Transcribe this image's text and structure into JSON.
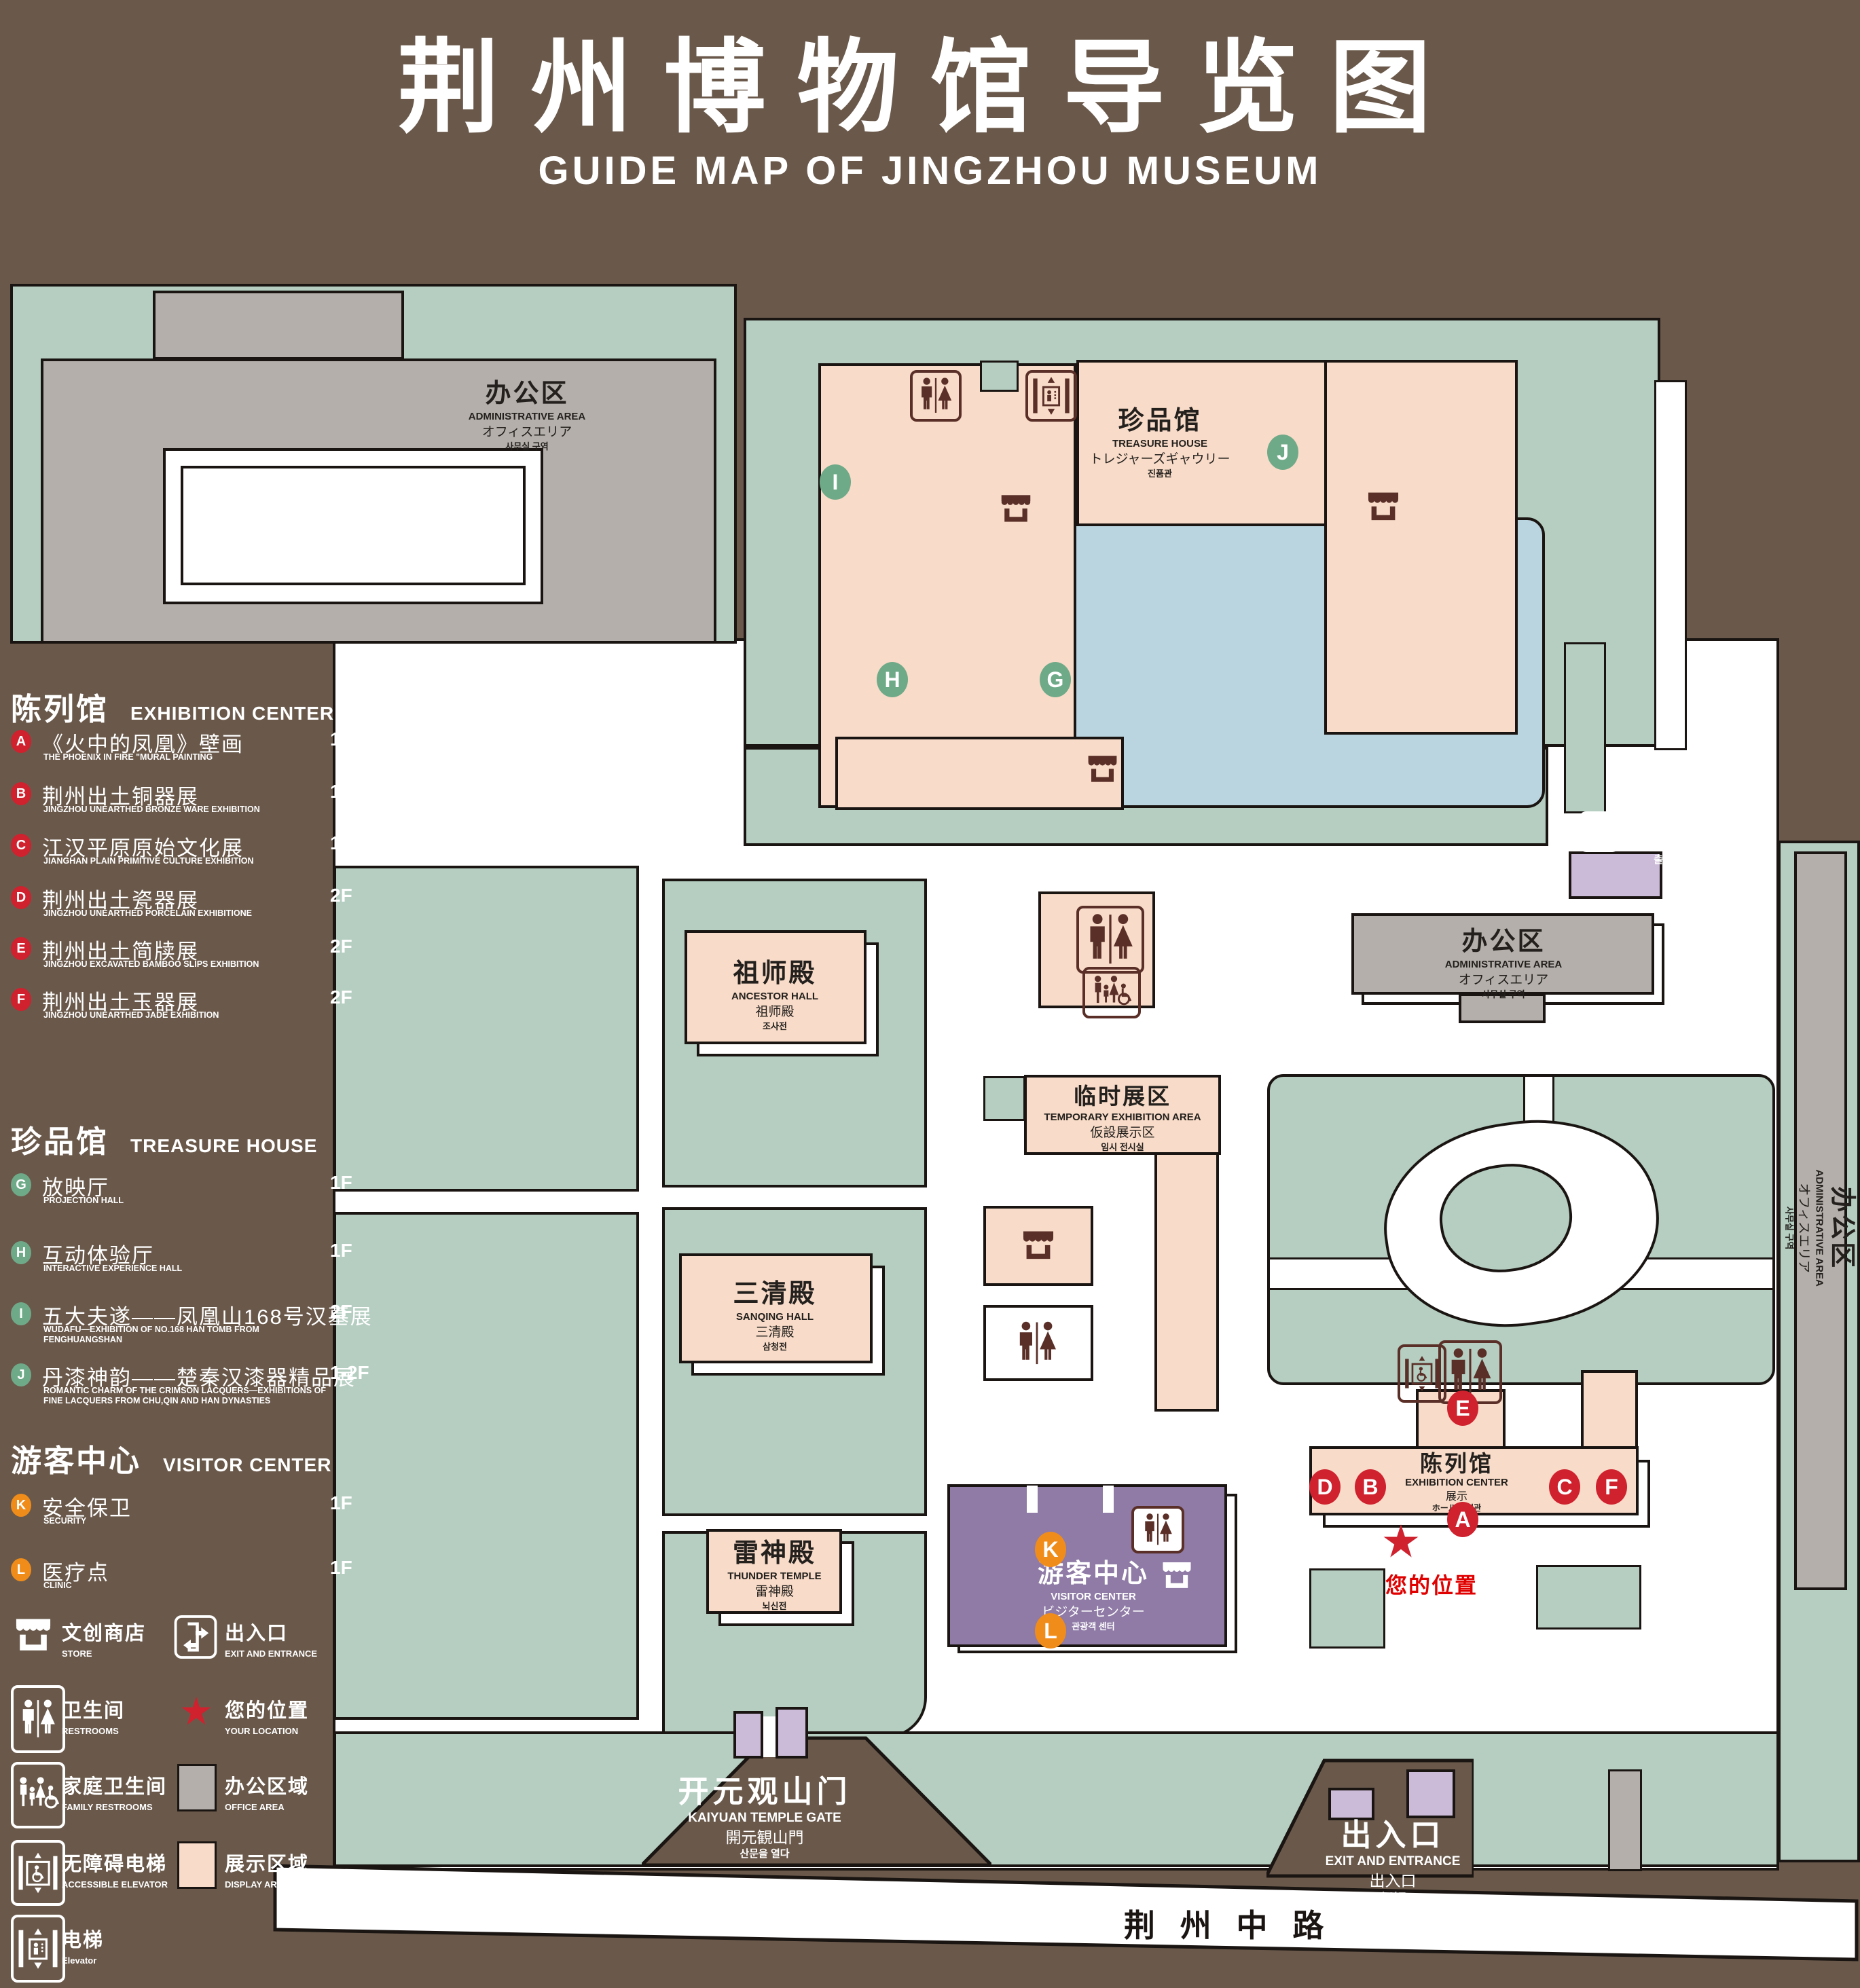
{
  "title": {
    "zh": "荆州博物馆导览图",
    "en": "GUIDE MAP OF JINGZHOU MUSEUM"
  },
  "colors": {
    "background": "#6a594b",
    "courtyard_green": "#b5cec1",
    "display_pink": "#f8dbc8",
    "office_gray": "#b4afab",
    "pond_blue": "#bad5df",
    "visitor_purple": "#8f7ba6",
    "gate_lavender": "#cbbbd9",
    "marker_red": "#cf212e",
    "marker_green": "#6faa88",
    "marker_orange": "#f08c1a",
    "icon_brown": "#5a2f28",
    "line_black": "#1a1512"
  },
  "legend": {
    "sections": [
      {
        "zh": "陈列馆",
        "en": "EXHIBITION CENTER",
        "items": [
          {
            "letter": "A",
            "zh": "《火中的凤凰》壁画",
            "en": "THE PHOENIX IN FIRE \"MURAL PAINTING",
            "floor": "1F"
          },
          {
            "letter": "B",
            "zh": "荆州出土铜器展",
            "en": "JINGZHOU UNEARTHED BRONZE WARE EXHIBITION",
            "floor": "1F"
          },
          {
            "letter": "C",
            "zh": "江汉平原原始文化展",
            "en": "JIANGHAN PLAIN PRIMITIVE CULTURE EXHIBITION",
            "floor": "1F"
          },
          {
            "letter": "D",
            "zh": "荆州出土瓷器展",
            "en": "JINGZHOU UNEARTHED PORCELAIN EXHIBITIONE",
            "floor": "2F"
          },
          {
            "letter": "E",
            "zh": "荆州出土简牍展",
            "en": "JINGZHOU EXCAVATED BAMBOO SLIPS EXHIBITION",
            "floor": "2F"
          },
          {
            "letter": "F",
            "zh": "荆州出土玉器展",
            "en": "JINGZHOU UNEARTHED JADE EXHIBITION",
            "floor": "2F"
          }
        ]
      },
      {
        "zh": "珍品馆",
        "en": "TREASURE HOUSE",
        "items": [
          {
            "letter": "G",
            "zh": "放映厅",
            "en": "PROJECTION HALL",
            "floor": "1F"
          },
          {
            "letter": "H",
            "zh": "互动体验厅",
            "en": "INTERACTIVE EXPERIENCE HALL",
            "floor": "1F"
          },
          {
            "letter": "I",
            "zh": "五大夫遂——凤凰山168号汉墓展",
            "en": "WUDAFU—EXHIBITION OF NO.168 HAN TOMB FROM FENGHUANGSHAN",
            "floor": "2F"
          },
          {
            "letter": "J",
            "zh": "丹漆神韵——楚秦汉漆器精品展",
            "en": "ROMANTIC CHARM OF THE CRIMSON LACQUERS—EXHIBITIONS OF FINE LACQUERS FROM CHU,QIN AND HAN DYNASTIES",
            "floor": "1-2F"
          }
        ]
      },
      {
        "zh": "游客中心",
        "en": "VISITOR CENTER",
        "items": [
          {
            "letter": "K",
            "zh": "安全保卫",
            "en": "SECURITY",
            "floor": "1F"
          },
          {
            "letter": "L",
            "zh": "医疗点",
            "en": "CLINIC",
            "floor": "1F"
          }
        ]
      }
    ],
    "symbols": [
      {
        "icon": "store-icon",
        "zh": "文创商店",
        "en": "STORE"
      },
      {
        "icon": "exit-icon",
        "zh": "出入口",
        "en": "EXIT AND ENTRANCE"
      },
      {
        "icon": "restroom-icon",
        "zh": "卫生间",
        "en": "RESTROOMS"
      },
      {
        "icon": "location-star-icon",
        "zh": "您的位置",
        "en": "YOUR LOCATION"
      },
      {
        "icon": "family-restroom-icon",
        "zh": "家庭卫生间",
        "en": "FAMILY RESTROOMS"
      },
      {
        "icon": "office-area-swatch",
        "zh": "办公区域",
        "en": "OFFICE AREA"
      },
      {
        "icon": "accessible-elevator-icon",
        "zh": "无障碍电梯",
        "en": "ACCESSIBLE ELEVATOR"
      },
      {
        "icon": "display-area-swatch",
        "zh": "展示区域",
        "en": "DISPLAY AREA"
      },
      {
        "icon": "elevator-icon",
        "zh": "电梯",
        "en": "Elevator"
      }
    ]
  },
  "map": {
    "buildings": {
      "admin": {
        "zh": "办公区",
        "en": "ADMINISTRATIVE AREA",
        "l3": "オフィスエリア",
        "l4": "사무실 구역"
      },
      "treasure": {
        "zh": "珍品馆",
        "en": "TREASURE HOUSE",
        "l3": "トレジャーズギャウリー",
        "l4": "진품관"
      },
      "ancestor": {
        "zh": "祖师殿",
        "en": "ANCESTOR HALL",
        "l3": "祖师殿",
        "l4": "조사전"
      },
      "temporary": {
        "zh": "临时展区",
        "en": "TEMPORARY EXHIBITION AREA",
        "l3": "仮設展示区",
        "l4": "임시 전시실"
      },
      "sanqing": {
        "zh": "三清殿",
        "en": "SANQING HALL",
        "l3": "三清殿",
        "l4": "삼청전"
      },
      "thunder": {
        "zh": "雷神殿",
        "en": "THUNDER TEMPLE",
        "l3": "雷神殿",
        "l4": "뇌신전"
      },
      "visitor": {
        "zh": "游客中心",
        "en": "VISITOR CENTER",
        "l3": "ビジターセンター",
        "l4": "관광객 센터"
      },
      "exhibition": {
        "zh": "陈列馆",
        "en": "EXHIBITION CENTER",
        "l3": "展示",
        "l4": "ホール 진열관"
      },
      "kaiyuan_gate": {
        "zh": "开元观山门",
        "en": "KAIYUAN TEMPLE GATE",
        "l3": "開元観山門",
        "l4": "산문을 열다"
      },
      "exit": {
        "zh": "出入口",
        "en": "EXIT AND ENTRANCE",
        "l3": "出入口",
        "l4": "출입구"
      }
    },
    "road": "荆 州 中 路",
    "your_location": "您的位置",
    "markers": {
      "A": "A",
      "B": "B",
      "C": "C",
      "D": "D",
      "E": "E",
      "F": "F",
      "G": "G",
      "H": "H",
      "I": "I",
      "J": "J",
      "K": "K",
      "L": "L"
    }
  }
}
